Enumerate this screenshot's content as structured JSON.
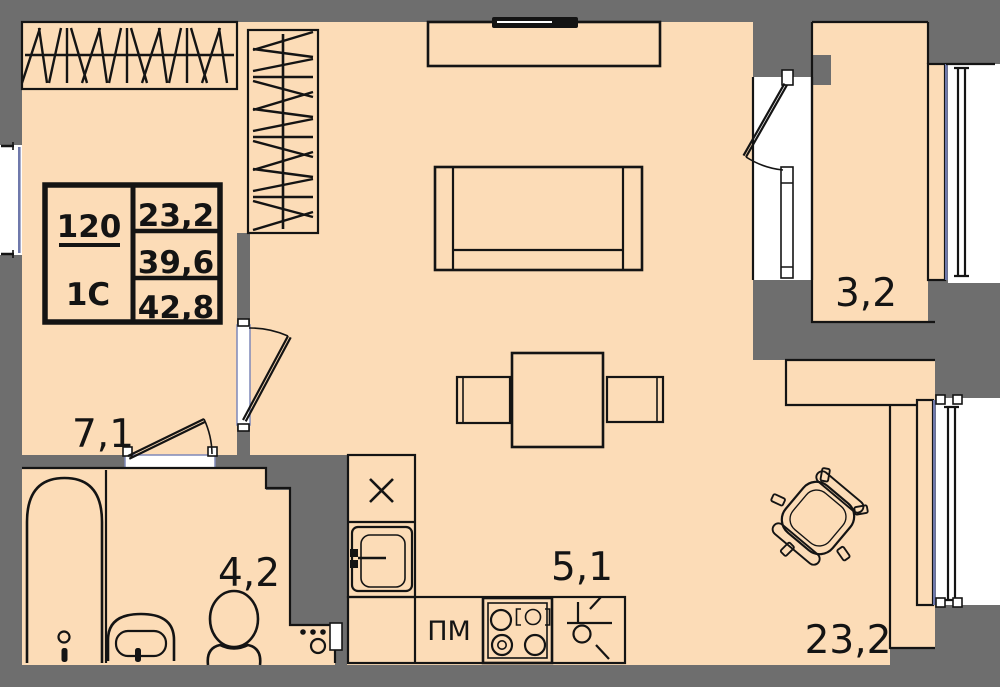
{
  "plan": {
    "legend": {
      "apartment_number": "120",
      "apartment_type": "1С",
      "areas": [
        "23,2",
        "39,6",
        "42,8"
      ]
    },
    "rooms": [
      {
        "id": "hallway",
        "area_label": "7,1"
      },
      {
        "id": "bathroom",
        "area_label": "4,2"
      },
      {
        "id": "kitchen",
        "area_label": "5,1"
      },
      {
        "id": "living-room",
        "area_label": "23,2"
      },
      {
        "id": "balcony",
        "area_label": "3,2"
      }
    ],
    "kitchen_labels": {
      "dishwasher": "ПМ",
      "fridge_mark": "×"
    },
    "colors": {
      "floor": "#fcdcb7",
      "wall": "#6e6e6e",
      "line": "#141414",
      "glazing": "#6f79ab",
      "opening": "#ffffff"
    }
  }
}
